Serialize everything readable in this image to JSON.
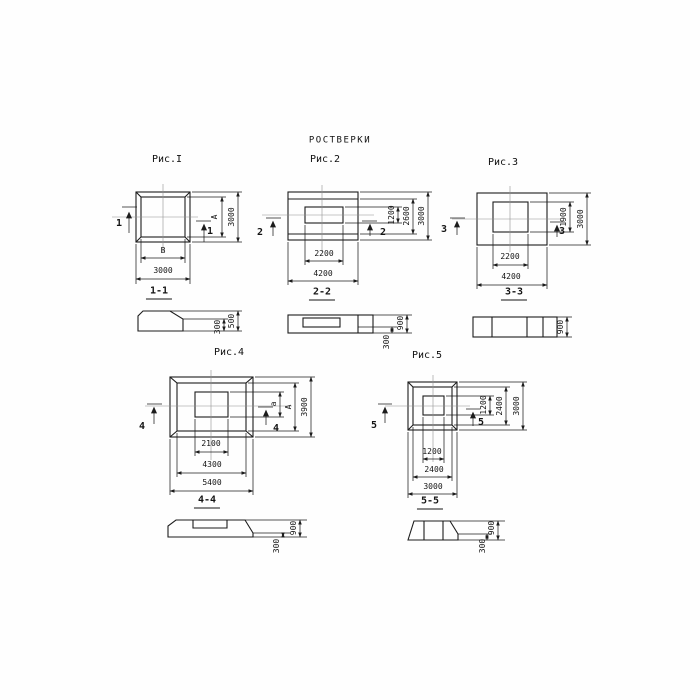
{
  "title": "РОСТВЕРКИ",
  "figures": [
    {
      "id": "fig1",
      "label": "Рис.I",
      "cut": "1",
      "section_label": "1-1",
      "dims": {
        "right_inner": "А",
        "right_outer": "3000",
        "bottom_inner": "В",
        "bottom_outer": "3000"
      },
      "section_dims": {
        "height": "500",
        "toe": "300"
      }
    },
    {
      "id": "fig2",
      "label": "Рис.2",
      "cut": "2",
      "section_label": "2-2",
      "dims": {
        "right_inner": "1200",
        "right_middle": "2600",
        "right_outer": "3000",
        "bottom_inner": "2200",
        "bottom_outer": "4200"
      },
      "section_dims": {
        "height": "900",
        "toe": "300"
      }
    },
    {
      "id": "fig3",
      "label": "Рис.3",
      "cut": "3",
      "section_label": "3-3",
      "dims": {
        "right_inner": "1900",
        "right_outer": "3000",
        "bottom_inner": "2200",
        "bottom_outer": "4200"
      },
      "section_dims": {
        "height": "900"
      }
    },
    {
      "id": "fig4",
      "label": "Рис.4",
      "cut": "4",
      "section_label": "4-4",
      "dims": {
        "right_inner": "а",
        "right_middle": "А",
        "right_outer": "3900",
        "bottom_inner": "2100",
        "bottom_middle": "4300",
        "bottom_outer": "5400"
      },
      "section_dims": {
        "height": "900",
        "toe": "300"
      }
    },
    {
      "id": "fig5",
      "label": "Рис.5",
      "cut": "5",
      "section_label": "5-5",
      "dims": {
        "right_inner": "1200",
        "right_middle": "2400",
        "right_outer": "3000",
        "bottom_inner": "1200",
        "bottom_middle": "2400",
        "bottom_outer": "3000"
      },
      "section_dims": {
        "height": "900",
        "toe": "300"
      }
    }
  ]
}
